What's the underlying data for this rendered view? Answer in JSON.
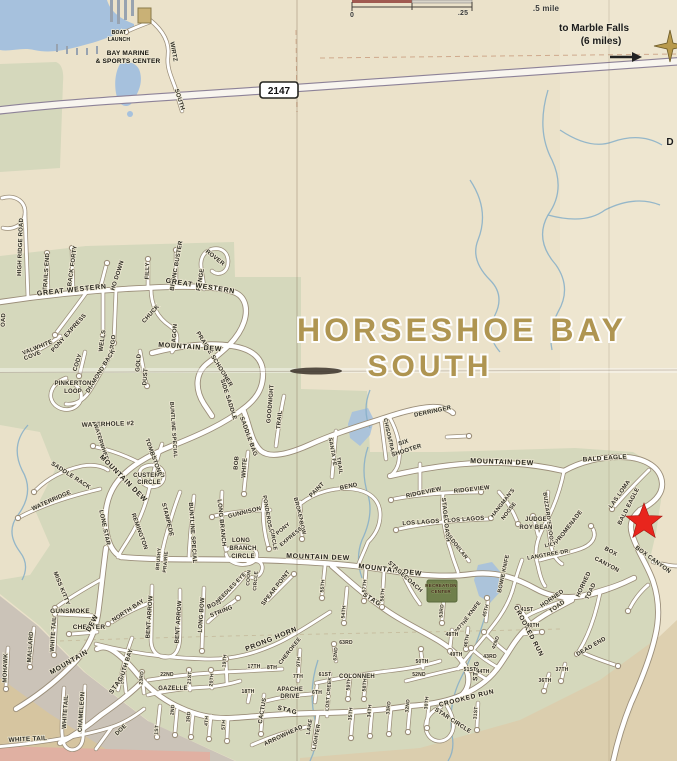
{
  "map": {
    "title_line1": "HORSESHOE BAY",
    "title_line2": "SOUTH",
    "highway_shield": "2147",
    "labels": [
      [
        "BOAT",
        119,
        34,
        0,
        5,
        "poi"
      ],
      [
        "LAUNCH",
        119,
        41,
        0,
        5,
        "poi"
      ],
      [
        "BAY MARINE",
        128,
        55,
        0,
        6.5,
        "poi"
      ],
      [
        "& SPORTS CENTER",
        128,
        63,
        0,
        6.5,
        "poi"
      ],
      [
        "WIRTZ",
        172,
        52,
        80,
        6
      ],
      [
        "SOUTH",
        178,
        100,
        72,
        6
      ],
      [
        "0",
        352,
        17,
        0,
        7,
        "dir2"
      ],
      [
        ".25",
        463,
        15,
        0,
        7,
        "dir2"
      ],
      [
        ".5 mile",
        546,
        11,
        0,
        8,
        "dir2"
      ],
      [
        "to Marble Falls",
        594,
        31,
        0,
        10,
        "dir"
      ],
      [
        "(6 miles)",
        601,
        44,
        0,
        10,
        "dir"
      ],
      [
        "D",
        670,
        145,
        0,
        10,
        "dir"
      ],
      [
        "HIGH RIDGE ROAD",
        22,
        247,
        -88,
        6
      ],
      [
        "OAD",
        5,
        320,
        -88,
        6
      ],
      [
        "TRAILS END",
        48,
        272,
        -86,
        6
      ],
      [
        "BACK FORTY",
        74,
        266,
        -82,
        6
      ],
      [
        "HO DOWN",
        119,
        276,
        -72,
        6
      ],
      [
        "FILLY",
        149,
        271,
        -88,
        6
      ],
      [
        "BRONC BUSTER",
        178,
        266,
        -80,
        6
      ],
      [
        "ROVER",
        214,
        259,
        38,
        6
      ],
      [
        "RANGE",
        202,
        280,
        -80,
        6
      ],
      [
        "GREAT WESTERN",
        72,
        292,
        -6,
        7,
        "mj"
      ],
      [
        "GREAT WESTERN",
        200,
        288,
        9,
        7,
        "mj"
      ],
      [
        "PONY EXPRESS",
        70,
        334,
        -48,
        6
      ],
      [
        "VALWHITE",
        38,
        349,
        -22,
        6
      ],
      [
        "COVE",
        33,
        357,
        -22,
        6
      ],
      [
        "WELLS",
        104,
        341,
        -82,
        6
      ],
      [
        "FARGO",
        114,
        346,
        -82,
        6
      ],
      [
        "CHUCK",
        152,
        315,
        -48,
        6
      ],
      [
        "WAGON",
        176,
        336,
        -85,
        6
      ],
      [
        "PRAIRIE SCHOONER",
        213,
        360,
        58,
        6
      ],
      [
        "MOUNTAIN DEW",
        190,
        349,
        4,
        7,
        "mj"
      ],
      [
        "CODY",
        79,
        363,
        -72,
        6
      ],
      [
        "DIAMOND BACK",
        102,
        372,
        -58,
        6
      ],
      [
        "GOLD",
        140,
        363,
        -85,
        6
      ],
      [
        "DUST",
        147,
        377,
        -85,
        6
      ],
      [
        "PINKERTON",
        73,
        385,
        0,
        6
      ],
      [
        "LOOP",
        73,
        393,
        0,
        6
      ],
      [
        "SIDE SADDLE",
        227,
        400,
        72,
        6
      ],
      [
        "WATERHOLE #2",
        108,
        426,
        -2,
        6.5
      ],
      [
        "GOODNIGHT",
        272,
        404,
        -85,
        6
      ],
      [
        "TRAIL",
        281,
        420,
        -85,
        6
      ],
      [
        "SADDLE BAG",
        247,
        437,
        70,
        6
      ],
      [
        "CUSTER'S",
        149,
        477,
        0,
        6
      ],
      [
        "CIRCLE",
        149,
        484,
        0,
        6
      ],
      [
        "BOB",
        238,
        463,
        -85,
        6
      ],
      [
        "WHITE",
        246,
        468,
        -85,
        6
      ],
      [
        "SANTA FE",
        331,
        452,
        80,
        5.5
      ],
      [
        "TRAIL",
        338,
        466,
        80,
        5.5
      ],
      [
        "CHISOM",
        386,
        430,
        78,
        5.5
      ],
      [
        "TRAIL",
        390,
        448,
        78,
        5.5
      ],
      [
        "WATERWHEEL",
        100,
        444,
        72,
        5.5
      ],
      [
        "MOUNTAIN DEW",
        122,
        480,
        45,
        7,
        "mj"
      ],
      [
        "TOMBSTONE",
        152,
        458,
        70,
        6
      ],
      [
        "SADDLE RACK",
        70,
        477,
        33,
        6
      ],
      [
        "WATERRIDGE",
        52,
        502,
        -24,
        6
      ],
      [
        "BUNTLINE SPECIAL",
        172,
        430,
        86,
        5.5
      ],
      [
        "LONE STAR",
        103,
        528,
        78,
        6
      ],
      [
        "REMINGTON",
        138,
        532,
        70,
        6
      ],
      [
        "STAMPEDE",
        166,
        520,
        76,
        6
      ],
      [
        "BUNTLINE SPECIAL",
        191,
        533,
        86,
        6
      ],
      [
        "LONG BRANCH",
        220,
        523,
        84,
        6
      ],
      [
        "GUNNISON",
        245,
        514,
        -14,
        6
      ],
      [
        "LONG",
        241,
        542,
        0,
        6
      ],
      [
        "BRANCH",
        243,
        550,
        0,
        6
      ],
      [
        "CIRCLE",
        243,
        558,
        0,
        6
      ],
      [
        "PONDEROSA",
        266,
        514,
        80,
        5.5
      ],
      [
        "CIRCLE",
        272,
        540,
        80,
        5.5
      ],
      [
        "BROKEN",
        297,
        510,
        75,
        5.5
      ],
      [
        "BOW",
        301,
        528,
        75,
        5.5
      ],
      [
        "PONY",
        284,
        530,
        -40,
        5.5
      ],
      [
        "EXPRESS",
        292,
        538,
        -40,
        5.5
      ],
      [
        "PAINT",
        318,
        491,
        -45,
        6
      ],
      [
        "BEND",
        349,
        488,
        -12,
        6
      ],
      [
        "DERRINGER",
        433,
        413,
        -12,
        6
      ],
      [
        "SIX",
        404,
        444,
        -18,
        6
      ],
      [
        "SHOOTER",
        407,
        452,
        -18,
        6
      ],
      [
        "MOUNTAIN DEW",
        502,
        464,
        2,
        7,
        "mj"
      ],
      [
        "BALD EAGLE",
        605,
        460,
        -4,
        6.5
      ],
      [
        "LAS LOMA",
        621,
        495,
        -55,
        6
      ],
      [
        "BALD EAGLE",
        630,
        507,
        -63,
        6
      ],
      [
        "RIDGEVIEW",
        424,
        494,
        -12,
        6
      ],
      [
        "RIDGEVIEW",
        472,
        491,
        -6,
        6
      ],
      [
        "STAGECOACH",
        444,
        520,
        84,
        6
      ],
      [
        "LOS LAGOS",
        421,
        524,
        -4,
        6
      ],
      [
        "LOS LAGOS",
        466,
        521,
        -4,
        6
      ],
      [
        "HANGMAN'S",
        504,
        504,
        -52,
        5.5
      ],
      [
        "NOOSE",
        510,
        512,
        -52,
        5.5
      ],
      [
        "BUZZARD'S ROOST",
        547,
        520,
        82,
        5.5
      ],
      [
        "JUDGE",
        536,
        521,
        0,
        6
      ],
      [
        "ROY BEAN",
        536,
        529,
        0,
        6
      ],
      [
        "SILVER",
        452,
        542,
        52,
        5.5
      ],
      [
        "DOLLAR",
        458,
        550,
        52,
        5.5
      ],
      [
        "PROMENADE",
        570,
        528,
        -52,
        6
      ],
      [
        "LILY",
        551,
        546,
        -14,
        5.5
      ],
      [
        "LANGTREE DR.",
        549,
        556,
        -10,
        5.5
      ],
      [
        "BOX",
        610,
        553,
        28,
        6
      ],
      [
        "CANYON",
        606,
        566,
        28,
        6
      ],
      [
        "BOX CANYON",
        652,
        561,
        36,
        6
      ],
      [
        "MOUNTAIN DEW",
        318,
        559,
        2,
        7,
        "mj"
      ],
      [
        "MOUNTAIN DEW",
        390,
        572,
        7,
        7,
        "mj"
      ],
      [
        "STAGECOACH",
        404,
        578,
        42,
        6
      ],
      [
        "RECREATION",
        441,
        587,
        0,
        4.5,
        "rec"
      ],
      [
        "CENTER",
        441,
        593,
        0,
        4.5,
        "rec"
      ],
      [
        "STAG",
        371,
        601,
        32,
        6.5,
        "mj"
      ],
      [
        "BOWIE KNIFE",
        505,
        574,
        -78,
        5.5
      ],
      [
        "BOWIE KNIFE",
        469,
        618,
        -52,
        5.5
      ],
      [
        "CROOKED RUN",
        527,
        632,
        62,
        6.5,
        "mj"
      ],
      [
        "CROOKED RUN",
        467,
        700,
        -14,
        6.5,
        "mj"
      ],
      [
        "HORNED",
        553,
        600,
        -35,
        6
      ],
      [
        "TOAD",
        558,
        608,
        -35,
        6
      ],
      [
        "HORNED",
        585,
        585,
        -65,
        6
      ],
      [
        "TOAD",
        592,
        592,
        -65,
        6
      ],
      [
        "DEAD END",
        592,
        648,
        -30,
        6
      ],
      [
        "STAR CIRCLE",
        452,
        722,
        33,
        6
      ],
      [
        "STAG",
        478,
        671,
        -85,
        6.5,
        "mj"
      ],
      [
        "57TH",
        366,
        586,
        -85,
        5
      ],
      [
        "56TH",
        384,
        595,
        -85,
        5
      ],
      [
        "55TH",
        324,
        586,
        -85,
        5
      ],
      [
        "54TH",
        345,
        612,
        -85,
        5
      ],
      [
        "53RD",
        443,
        611,
        -85,
        5
      ],
      [
        "45TH",
        487,
        611,
        -75,
        5
      ],
      [
        "41ST",
        527,
        611,
        0,
        5
      ],
      [
        "40TH",
        533,
        627,
        0,
        5
      ],
      [
        "42ND",
        497,
        643,
        -70,
        5
      ],
      [
        "43RD",
        490,
        658,
        0,
        5
      ],
      [
        "44TH",
        483,
        673,
        0,
        5
      ],
      [
        "46TH",
        468,
        641,
        -80,
        5
      ],
      [
        "48TH",
        452,
        636,
        0,
        5
      ],
      [
        "47TH",
        463,
        626,
        -45,
        5
      ],
      [
        "49TH",
        456,
        656,
        0,
        5
      ],
      [
        "50TH",
        422,
        663,
        0,
        5
      ],
      [
        "51ST",
        470,
        671,
        0,
        5
      ],
      [
        "52ND",
        419,
        676,
        0,
        5
      ],
      [
        "58TH",
        366,
        685,
        -85,
        5
      ],
      [
        "59TH",
        350,
        684,
        -85,
        5
      ],
      [
        "61ST",
        325,
        676,
        0,
        5
      ],
      [
        "62ND",
        337,
        654,
        -85,
        5
      ],
      [
        "63RD",
        346,
        644,
        0,
        5
      ],
      [
        "COLONNEH",
        357,
        678,
        0,
        6
      ],
      [
        "LOST CREEK",
        330,
        694,
        -85,
        5
      ],
      [
        "37TH",
        562,
        671,
        0,
        5
      ],
      [
        "36TH",
        545,
        682,
        0,
        5
      ],
      [
        "35TH",
        352,
        714,
        -85,
        5
      ],
      [
        "34TH",
        371,
        711,
        -85,
        5
      ],
      [
        "33RD",
        390,
        708,
        -85,
        5
      ],
      [
        "32ND",
        409,
        706,
        -85,
        5
      ],
      [
        "30TH",
        428,
        703,
        -85,
        5
      ],
      [
        "31ST",
        477,
        713,
        -85,
        5
      ],
      [
        "PRONG HORN",
        272,
        641,
        -22,
        7,
        "mj"
      ],
      [
        "CHEROKEE",
        291,
        652,
        -52,
        5.5
      ],
      [
        "17TH",
        254,
        668,
        0,
        5
      ],
      [
        "8TH",
        272,
        669,
        0,
        5
      ],
      [
        "9TH",
        300,
        662,
        -85,
        5
      ],
      [
        "7TH",
        298,
        678,
        0,
        5
      ],
      [
        "18TH",
        248,
        693,
        0,
        5
      ],
      [
        "APACHE",
        290,
        691,
        0,
        6
      ],
      [
        "DRIVE",
        290,
        698,
        0,
        6
      ],
      [
        "CACTUS",
        264,
        711,
        -80,
        6
      ],
      [
        "STAG",
        287,
        712,
        14,
        6.5,
        "mj"
      ],
      [
        "6TH",
        317,
        694,
        0,
        5
      ],
      [
        "LAKE",
        311,
        727,
        -80,
        5.5
      ],
      [
        "LIGHTER",
        318,
        737,
        -80,
        5.5
      ],
      [
        "ARROWHEAD",
        284,
        737,
        -25,
        6
      ],
      [
        "22ND",
        167,
        676,
        0,
        5
      ],
      [
        "GAZELLE",
        173,
        690,
        0,
        6
      ],
      [
        "23RD",
        143,
        678,
        -85,
        5
      ],
      [
        "24TH",
        124,
        678,
        -85,
        5
      ],
      [
        "21ST",
        191,
        678,
        -85,
        5
      ],
      [
        "20TH",
        213,
        680,
        -85,
        5
      ],
      [
        "19TH",
        226,
        661,
        -85,
        5
      ],
      [
        "1ST",
        158,
        730,
        -85,
        5
      ],
      [
        "2ND",
        174,
        710,
        -85,
        5
      ],
      [
        "3RD",
        190,
        717,
        -85,
        5
      ],
      [
        "4TH",
        208,
        721,
        -85,
        5
      ],
      [
        "5TH",
        225,
        725,
        -85,
        5
      ],
      [
        "MISS KITTY",
        60,
        589,
        68,
        6
      ],
      [
        "GUNSMOKE",
        70,
        613,
        0,
        6.5
      ],
      [
        "CHESTER",
        89,
        629,
        0,
        6.5
      ],
      [
        "DEW",
        94,
        624,
        -62,
        7,
        "mj"
      ],
      [
        "MOUNTAIN",
        70,
        664,
        -30,
        7,
        "mj"
      ],
      [
        "NORTH BAY",
        129,
        612,
        -33,
        6
      ],
      [
        "SOUTH BAY",
        127,
        667,
        -72,
        6
      ],
      [
        "BENT ARROW",
        151,
        617,
        -86,
        6
      ],
      [
        "BENT ARROW",
        180,
        622,
        -86,
        6
      ],
      [
        "LONG BOW",
        203,
        615,
        -86,
        6
      ],
      [
        "BOW",
        215,
        606,
        -22,
        6
      ],
      [
        "STRING",
        222,
        613,
        -22,
        6
      ],
      [
        "NEEDLES EYE",
        232,
        589,
        -46,
        5.5
      ],
      [
        "COON",
        250,
        578,
        -85,
        5
      ],
      [
        "CIRCLE",
        257,
        581,
        -85,
        5
      ],
      [
        "SPEAR POINT",
        277,
        589,
        -52,
        6
      ],
      [
        "BRUSHY",
        160,
        559,
        -85,
        5
      ],
      [
        "PRAIRIE",
        167,
        562,
        -85,
        5
      ],
      [
        "STAG",
        118,
        686,
        -55,
        6.5,
        "mj"
      ],
      [
        "DOE",
        122,
        731,
        -45,
        6
      ],
      [
        "WHITE TAIL",
        55,
        634,
        -86,
        6
      ],
      [
        "MALLARD",
        32,
        647,
        -86,
        6
      ],
      [
        "MOHAWK",
        7,
        668,
        -88,
        6
      ],
      [
        "WHITETAIL",
        67,
        712,
        -86,
        6
      ],
      [
        "CHAMELEON",
        83,
        712,
        -86,
        6
      ],
      [
        "WHITE TAIL",
        28,
        741,
        -3,
        6.5
      ]
    ]
  },
  "palette": {
    "paper": "#ebe2ca",
    "green": "#d5d8bc",
    "water": "#a6c1dd",
    "creek": "#85aec8",
    "casing": "#9b8e79",
    "hwycase": "#8d8298",
    "star": "#e8251d",
    "title": "#ac914b",
    "grayland": "#cbc3b8",
    "pink": "#e0b0a2",
    "tanband": "#dccdac",
    "recreation": "#6f7f4b"
  }
}
